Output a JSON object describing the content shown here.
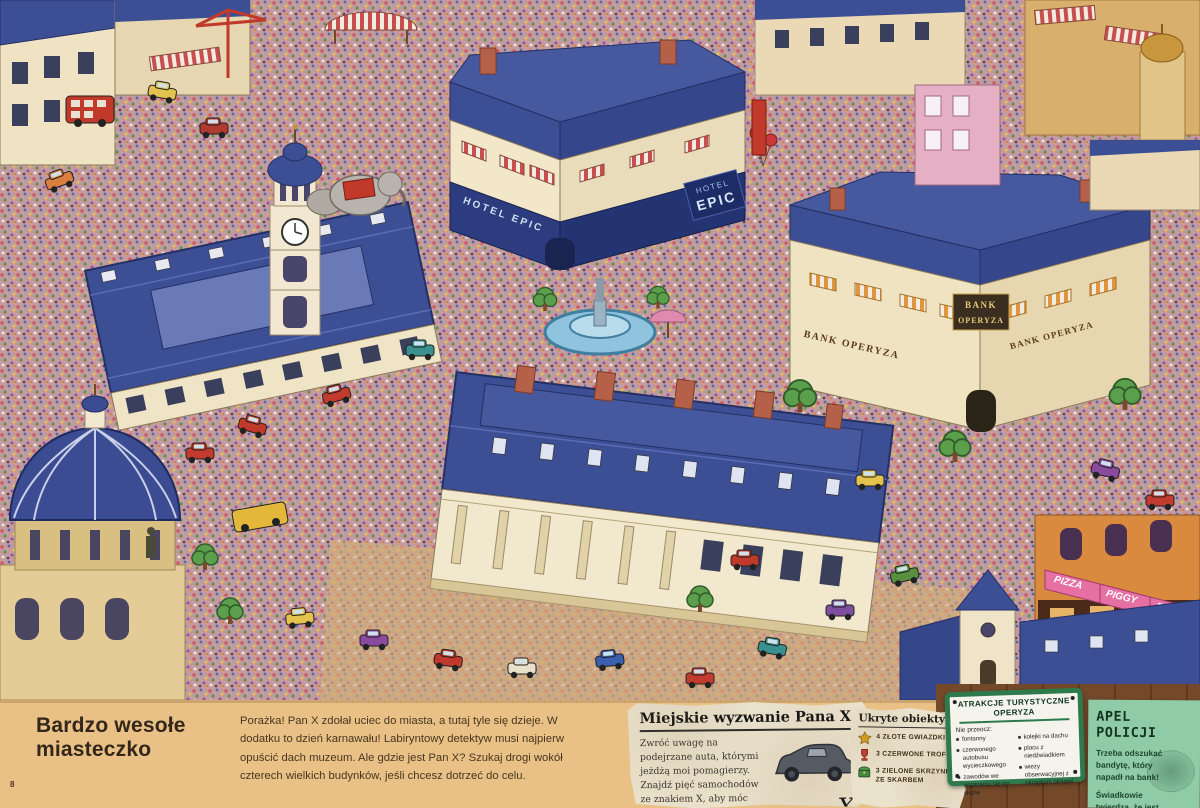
{
  "page": {
    "number": "8",
    "title": "Bardzo wesołe miasteczko",
    "intro": "Porażka! Pan X zdołał uciec do miasta, a tutaj tyle się dzieje. W dodatku to dzień karnawału! Labiryntowy detektyw musi najpierw opuścić dach muzeum. Ale gdzie jest Pan X? Szukaj drogi wokół czterech wielkich budynków, jeśli chcesz dotrzeć do celu."
  },
  "challenge": {
    "title": "Miejskie wyzwanie Pana X",
    "body": "Zwróć uwagę na podejrzane auta, którymi jeżdżą moi pomagierzy. Znajdź pięć samochodów ze znakiem X, aby móc ścigać mnie dalej.",
    "car_mark": "X"
  },
  "hidden": {
    "title": "Ukryte obiekty",
    "items": [
      {
        "icon": "gold-star",
        "label": "4 złote gwiazdki"
      },
      {
        "icon": "red-trophy",
        "label": "3 czerwone trofea"
      },
      {
        "icon": "green-chest",
        "label": "3 zielone skrzynki ze skarbem"
      }
    ]
  },
  "attractions": {
    "title1": "ATRAKCJE TURYSTYCZNE",
    "title2": "OPERYZA",
    "intro": "Nie przeocz:",
    "col1": [
      "fontanny",
      "czerwonego autobusu wycieczkowego",
      "zawodów we wspinaniu się po słupie"
    ],
    "col2": [
      "kolejki na dachu",
      "placu z niedźwiadkiem",
      "wieży obserwacyjnej z okrągłymi oknami"
    ]
  },
  "police": {
    "title": "APEL POLICJI",
    "line1": "Trzeba odszukać bandytę, który napadł na bank!",
    "line2": "Świadkowie twierdzą, że jest uzbrojony."
  },
  "landmarks": {
    "hotel_full": "HOTEL EPIC",
    "hotel_small": "HOTEL",
    "hotel_big": "EPIC",
    "bank_side": "BANK OPERYZA",
    "bank_line1": "BANK",
    "bank_line2": "OPERYZA",
    "pizza": [
      "PIZZA",
      "PIGGY",
      "PIZZA"
    ]
  },
  "colors": {
    "roof_blue": "#3d4f94",
    "facade_cream": "#f2e7c9",
    "street_crowd": "#c49a9e",
    "footer_tan": "#e9c186",
    "sign_green": "#2f7a4c",
    "note_green": "#8fcba6",
    "paper": "#ebe2cc",
    "pizza_pink": "#e66fa3"
  }
}
